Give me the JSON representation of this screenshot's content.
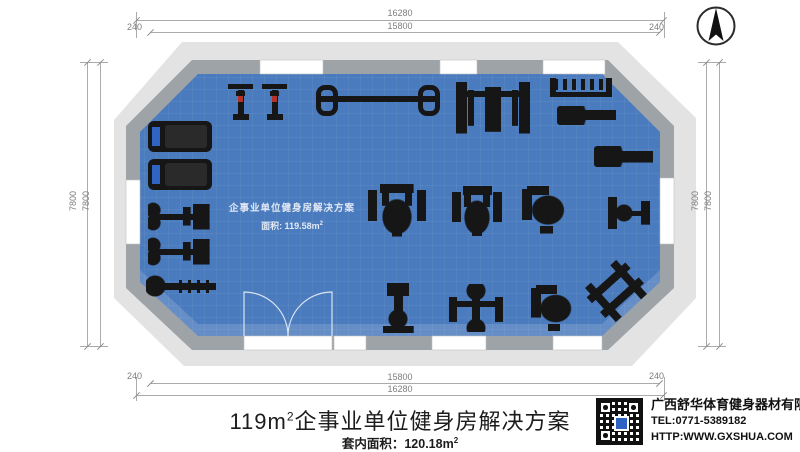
{
  "dimensions": {
    "top": {
      "outer": "16280",
      "inner": "15800",
      "left_offset": "240",
      "right_offset": "240"
    },
    "bottom": {
      "outer": "16280",
      "inner": "15800",
      "left_offset": "240",
      "right_offset": "240"
    },
    "left": {
      "outer": "7800",
      "inner": "7800"
    },
    "right": {
      "outer": "7800",
      "inner": "7800"
    }
  },
  "floor_label": {
    "line1": "企事业单位健身房解决方案",
    "line2_prefix": "面积: 119.58m",
    "line2_sup": "2"
  },
  "title": {
    "prefix": "119m",
    "sup": "2",
    "main": "企事业单位健身房解决方案"
  },
  "subtitle": {
    "prefix": "套内面积：120.18m",
    "sup": "2"
  },
  "company": {
    "name": "广西舒华体育健身器材有限公司",
    "tel": "TEL:0771-5389182",
    "web": "HTTP:WWW.GXSHUA.COM"
  },
  "colors": {
    "floor": "#4a7bbe",
    "wall": "#9ea3a8",
    "wall_outer": "#e3e3e3",
    "equipment": "#161616",
    "dimension": "#7d7d7d"
  },
  "equipment": [
    {
      "type": "treadmill",
      "x": 148,
      "y": 121,
      "w": 64,
      "h": 31
    },
    {
      "type": "treadmill",
      "x": 148,
      "y": 159,
      "w": 64,
      "h": 31
    },
    {
      "type": "spin-bike",
      "x": 228,
      "y": 84,
      "w": 25,
      "h": 36
    },
    {
      "type": "spin-bike",
      "x": 262,
      "y": 84,
      "w": 25,
      "h": 36
    },
    {
      "type": "barbell-rack",
      "x": 316,
      "y": 85,
      "w": 124,
      "h": 31
    },
    {
      "type": "bench-press",
      "x": 456,
      "y": 80,
      "w": 74,
      "h": 56
    },
    {
      "type": "dumbbell-rack",
      "x": 550,
      "y": 78,
      "w": 62,
      "h": 19
    },
    {
      "type": "flat-bench",
      "x": 557,
      "y": 106,
      "w": 59,
      "h": 19
    },
    {
      "type": "flat-bench",
      "x": 594,
      "y": 146,
      "w": 59,
      "h": 21
    },
    {
      "type": "small-machine",
      "x": 608,
      "y": 197,
      "w": 42,
      "h": 32
    },
    {
      "type": "recumbent-bike",
      "x": 148,
      "y": 202,
      "w": 64,
      "h": 29
    },
    {
      "type": "recumbent-bike",
      "x": 148,
      "y": 237,
      "w": 64,
      "h": 29
    },
    {
      "type": "rower",
      "x": 146,
      "y": 274,
      "w": 70,
      "h": 24
    },
    {
      "type": "strength-machine",
      "x": 368,
      "y": 182,
      "w": 58,
      "h": 56
    },
    {
      "type": "strength-machine",
      "x": 452,
      "y": 184,
      "w": 50,
      "h": 54
    },
    {
      "type": "seated-machine",
      "x": 517,
      "y": 182,
      "w": 50,
      "h": 54
    },
    {
      "type": "upright-machine",
      "x": 382,
      "y": 283,
      "w": 32,
      "h": 50
    },
    {
      "type": "arm-machine",
      "x": 449,
      "y": 284,
      "w": 54,
      "h": 48
    },
    {
      "type": "seated-machine",
      "x": 526,
      "y": 282,
      "w": 48,
      "h": 51
    },
    {
      "type": "tilted-bench",
      "x": 590,
      "y": 268,
      "w": 52,
      "h": 46,
      "rot": -42
    }
  ]
}
